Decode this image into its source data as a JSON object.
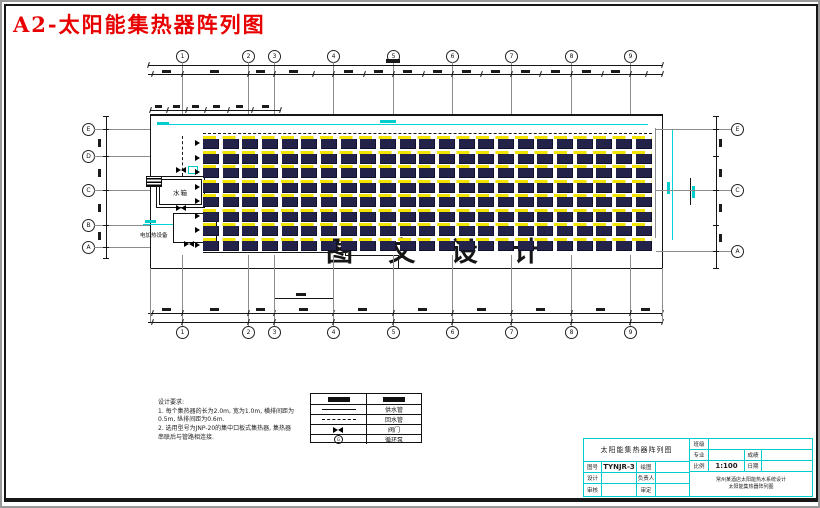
{
  "sheet": {
    "label": "A2-太阳能集热器阵列图"
  },
  "drawing": {
    "grid": {
      "top": [
        "1",
        "2",
        "3",
        "4",
        "5",
        "6",
        "7",
        "8",
        "9"
      ],
      "bottom": [
        "1",
        "2",
        "3",
        "4",
        "5",
        "6",
        "7",
        "8",
        "9"
      ],
      "left": [
        "E",
        "D",
        "C",
        "B",
        "A"
      ],
      "right": [
        "E",
        "C",
        "A"
      ]
    },
    "labels": {
      "water_tank": "水箱",
      "electric_heater": "电加热设备"
    },
    "watermark": "图 文 设 计",
    "array": {
      "rows": 8,
      "columns": 23
    },
    "colors": {
      "panel": "#23234a",
      "manifold_yellow": "#f2e300",
      "accent_cyan": "#00d4d4",
      "title_red": "#e80000"
    }
  },
  "legend": {
    "rows": [
      {
        "symbol": "collector-bar",
        "label_symbol": "collector-bar",
        "label": ""
      },
      {
        "symbol": "solid-line",
        "label": "供水管"
      },
      {
        "symbol": "dashed-line",
        "label": "回水管"
      },
      {
        "symbol": "valve",
        "label": "阀门"
      },
      {
        "symbol": "pump",
        "label": "循环泵"
      }
    ]
  },
  "notes": {
    "title": "设计要求:",
    "items": [
      "1. 每个集热器的长为2.0m, 宽为1.0m, 横排间距为0.5m, 纵排间距为0.6m.",
      "2. 选用型号为JNP-20的集中口板式集热器, 集热器串联后与管路相连接."
    ]
  },
  "title_block": {
    "drawing_title": "太阳能集热器阵列图",
    "project_line1": "常州某酒店太阳能热水系统设计",
    "project_line2": "太阳能集热器阵列图",
    "fields": {
      "class_label": "班级",
      "class_value": "",
      "major_label": "专业",
      "major_value": "",
      "grade_label": "成绩",
      "grade_value": "",
      "scale_label": "比例",
      "scale_value": "1:100",
      "date_label": "日期",
      "date_value": "",
      "no_label": "图号",
      "no_value": "TYNJR-3",
      "draft_label": "绘图",
      "draft_value": "",
      "design_label": "设计",
      "design_value": "",
      "lead_label": "负责人",
      "lead_value": "",
      "review_label": "审核",
      "review_value": "",
      "approve_label": "审定",
      "approve_value": ""
    }
  }
}
